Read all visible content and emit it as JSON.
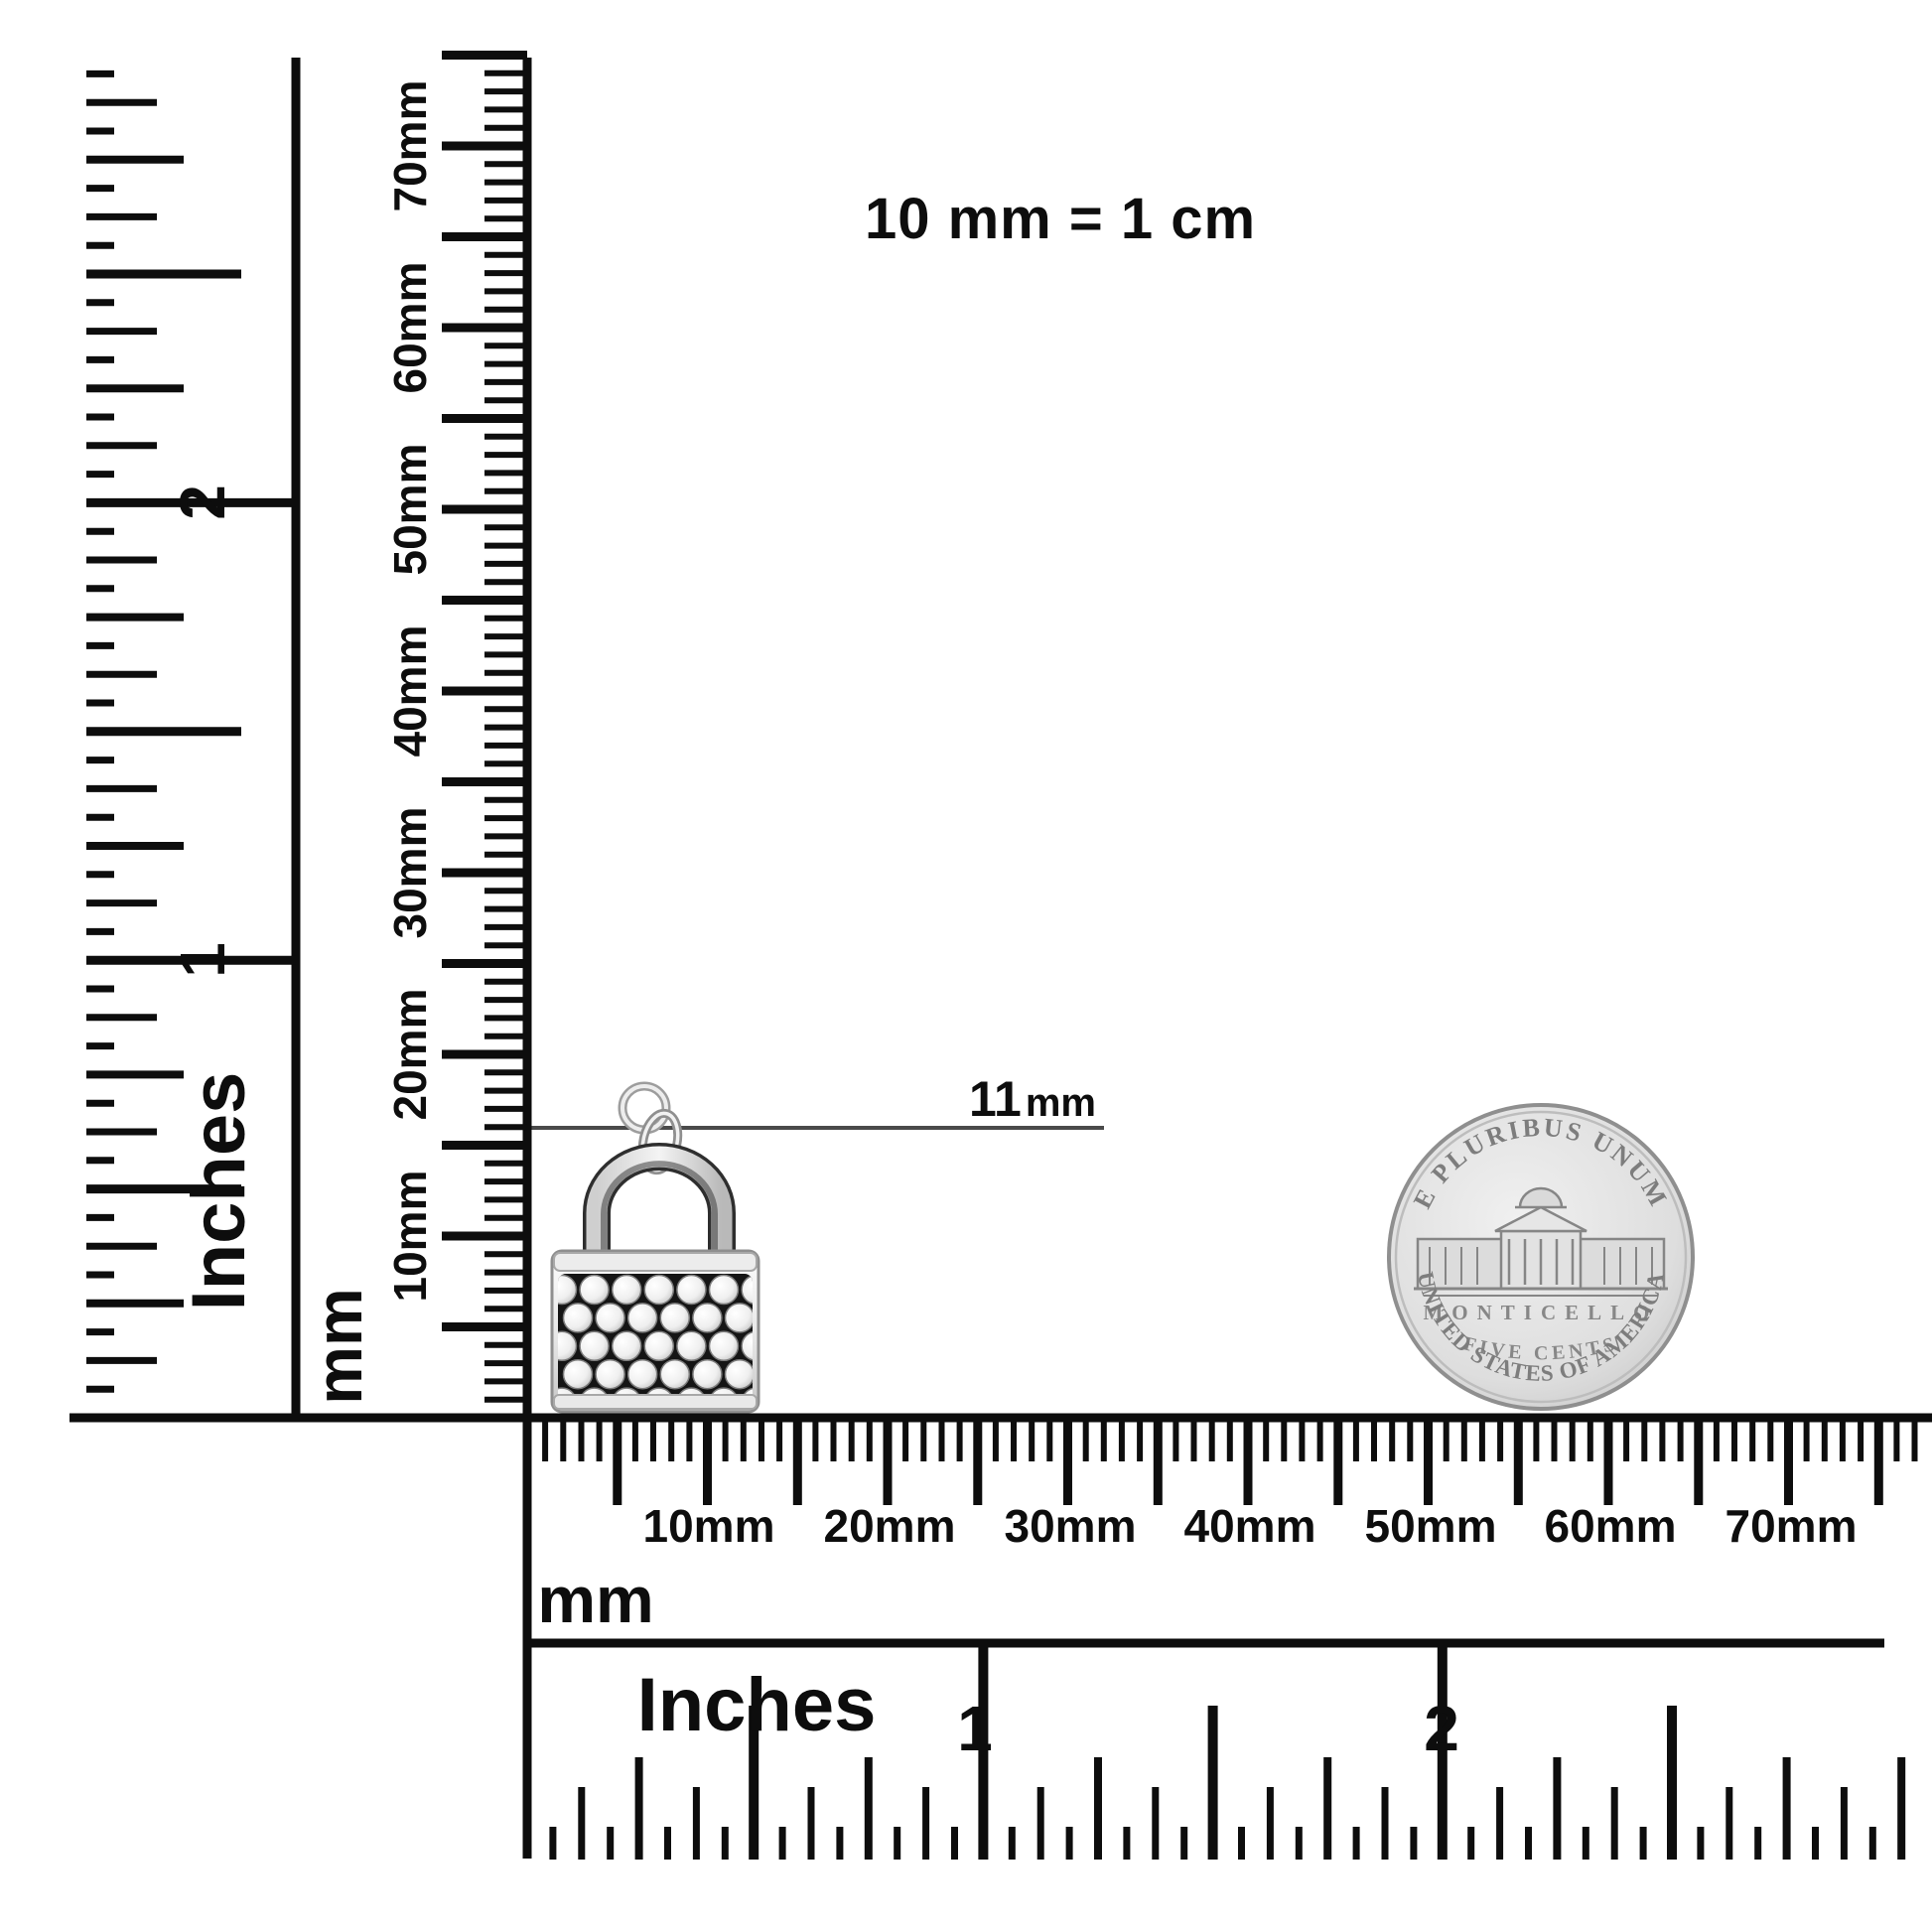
{
  "scale_note": "10 mm = 1 cm",
  "annotation": {
    "value": "11",
    "unit": "mm"
  },
  "rulers": {
    "left_inches": {
      "unit_label": "Inches",
      "tick_labels": [
        "2",
        "1"
      ]
    },
    "left_mm": {
      "unit_label": "mm",
      "tick_labels": [
        "70mm",
        "60mm",
        "50mm",
        "40mm",
        "30mm",
        "20mm",
        "10mm"
      ]
    },
    "bottom_mm": {
      "unit_label": "mm",
      "tick_labels": [
        "10mm",
        "20mm",
        "30mm",
        "40mm",
        "50mm",
        "60mm",
        "70mm"
      ]
    },
    "bottom_inches": {
      "unit_label": "Inches",
      "tick_labels": [
        "1",
        "2"
      ]
    }
  },
  "coin": {
    "legend_top": "E PLURIBUS UNUM",
    "building_label": "MONTICELLO",
    "denomination": "FIVE CENTS",
    "legend_bottom": "UNITED STATES OF AMERICA"
  },
  "colors": {
    "ink": "#0d0d0d",
    "annotation_line": "#4a4a4a",
    "coin_engraving": "#878787",
    "silver_light": "#f0f0f0",
    "silver_mid": "#9a9a9a",
    "pave_background": "#151515"
  }
}
